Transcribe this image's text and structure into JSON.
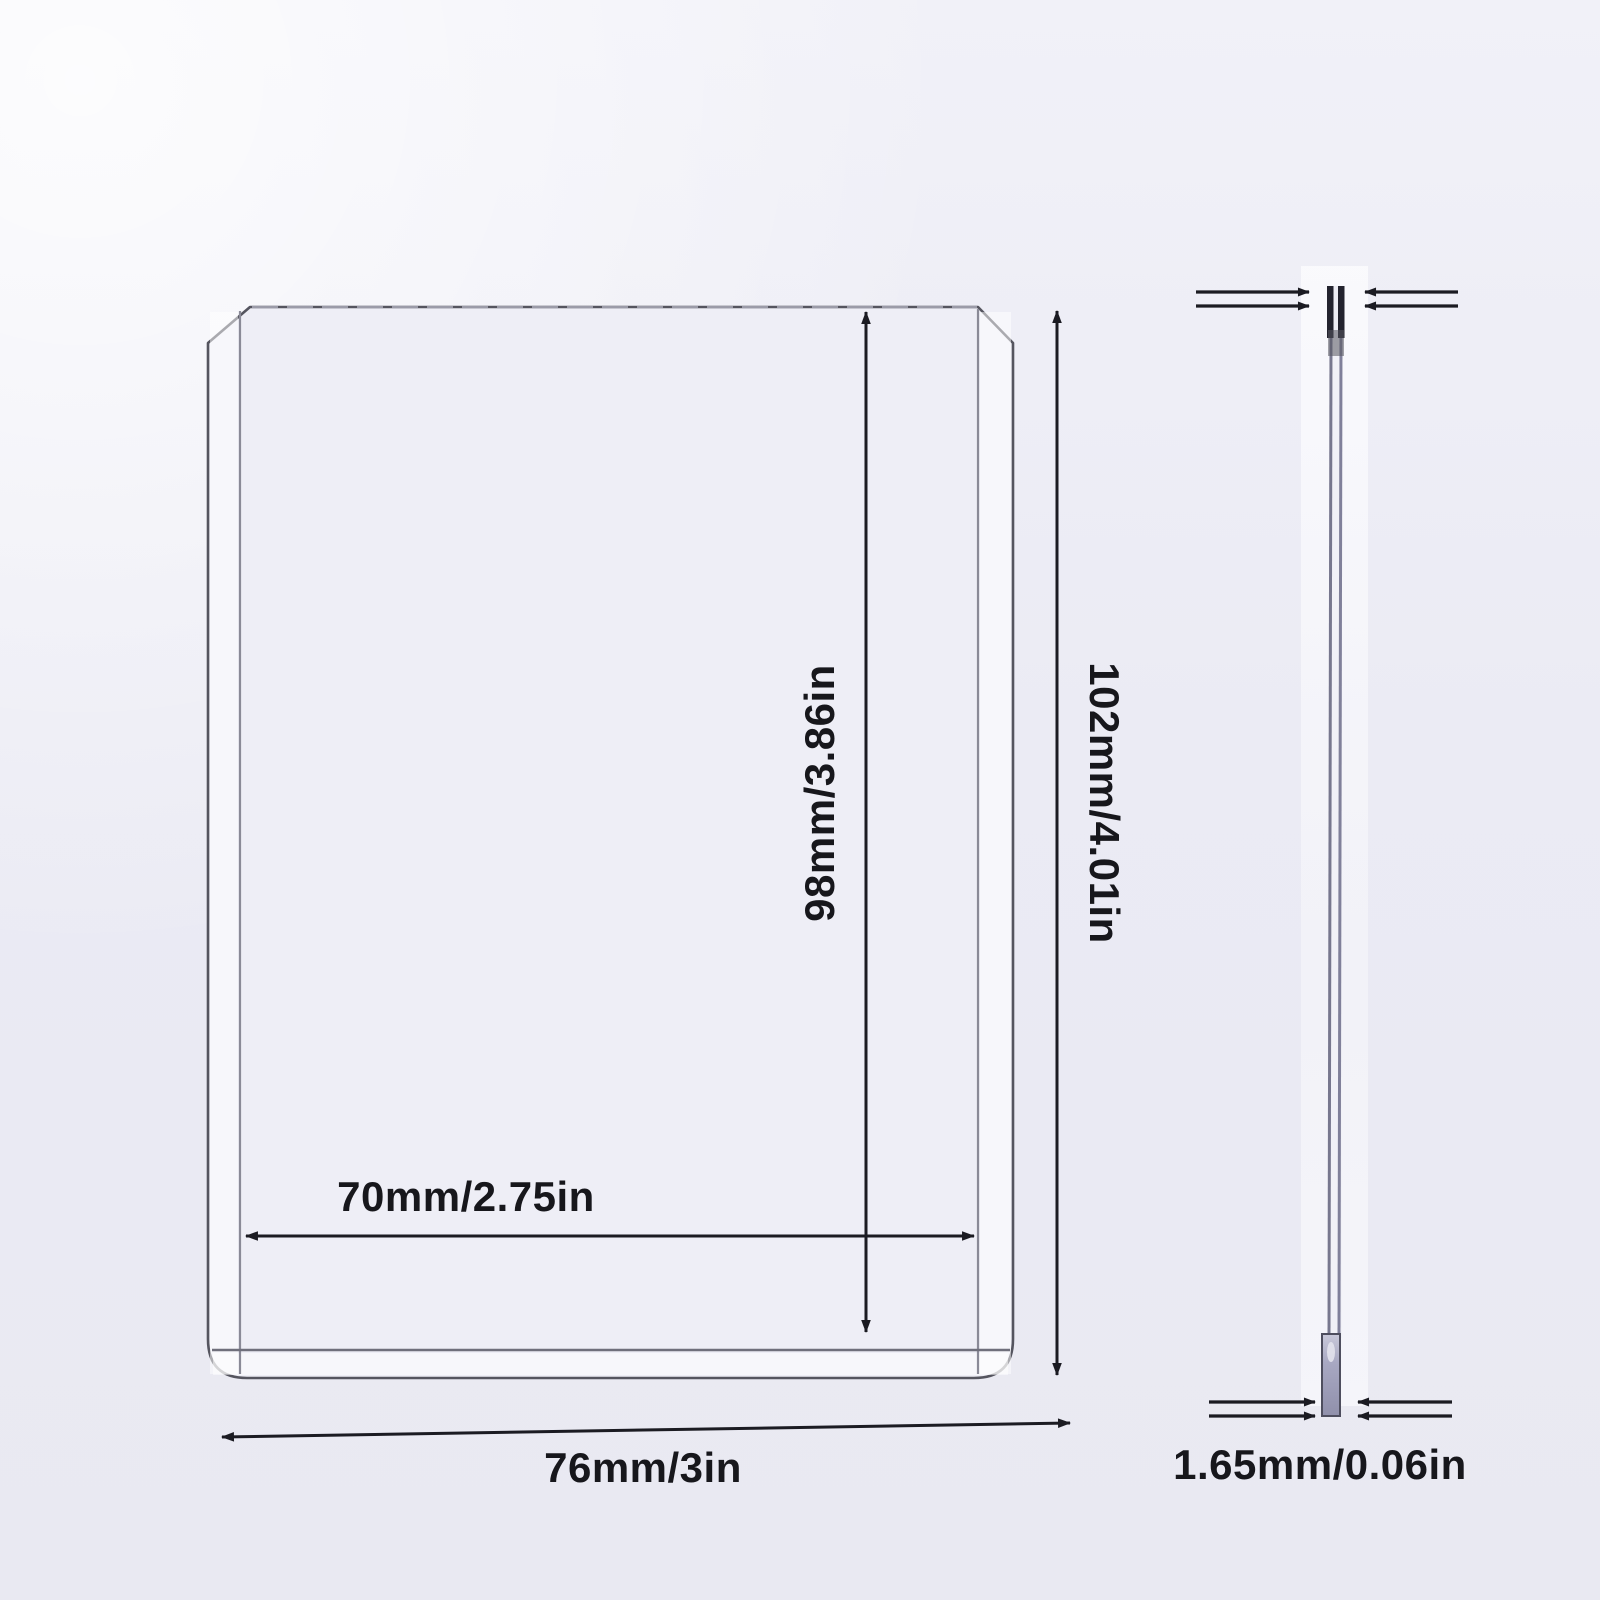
{
  "front_view": {
    "outer_height_label": "102mm/4.01in",
    "inner_height_label": "98mm/3.86in",
    "inner_width_label": "70mm/2.75in",
    "outer_width_label": "76mm/3in"
  },
  "side_view": {
    "thickness_label": "1.65mm/0.06in"
  },
  "colors": {
    "background": "#ebecf4",
    "dimension_line": "#1b1b22",
    "label_text": "#17171c",
    "card_edge": "#55555f",
    "side_strip_fill": "#a8a8c2",
    "side_strip_dark_top": "#23232e",
    "highlight_band": "#f9f9fc"
  }
}
